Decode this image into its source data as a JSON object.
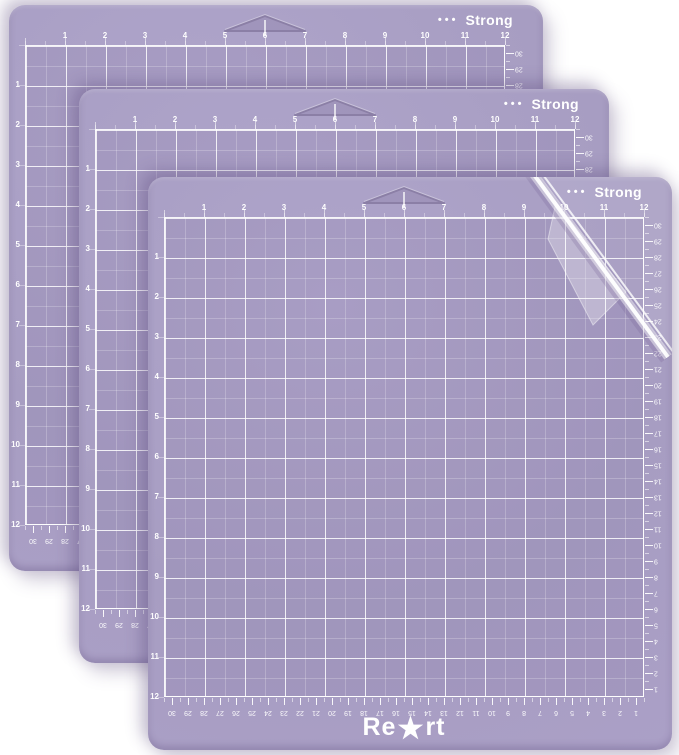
{
  "colors": {
    "background": "#ffffff",
    "mat_purple": "#a79dc2",
    "mat_purple_light": "#afa5cb",
    "mat_purple_edge": "#aba0c7",
    "grid_line": "#ffffff",
    "label_text": "#ffffff",
    "notch_outline": "#8b7fa6"
  },
  "strong_label": {
    "dots": "•••",
    "text": "Strong"
  },
  "logo": {
    "left": "Re",
    "star": "★",
    "right": "rt",
    "full_name": "ReArt"
  },
  "rulers": {
    "top_inches": [
      1,
      2,
      3,
      4,
      5,
      6,
      7,
      8,
      9,
      10,
      11,
      12
    ],
    "left_inches": [
      1,
      2,
      3,
      4,
      5,
      6,
      7,
      8,
      9,
      10,
      11,
      12
    ],
    "right_cm": [
      30,
      29,
      28,
      27,
      26,
      25,
      24,
      23,
      22,
      21,
      20,
      19,
      18,
      17,
      16,
      15,
      14,
      13,
      12,
      11,
      10,
      9,
      8,
      7,
      6,
      5,
      4,
      3,
      2,
      1
    ],
    "bottom_cm": [
      30,
      29,
      28,
      27,
      26,
      25,
      24,
      23,
      22,
      21,
      20,
      19,
      18,
      17,
      16,
      15,
      14,
      13,
      12,
      11,
      10,
      9,
      8,
      7,
      6,
      5,
      4,
      3,
      2,
      1
    ]
  },
  "mats": [
    {
      "label": "back mat",
      "has_logo": false,
      "has_film_peel": false
    },
    {
      "label": "middle mat",
      "has_logo": false,
      "has_film_peel": false
    },
    {
      "label": "front mat",
      "has_logo": true,
      "has_film_peel": true
    }
  ]
}
